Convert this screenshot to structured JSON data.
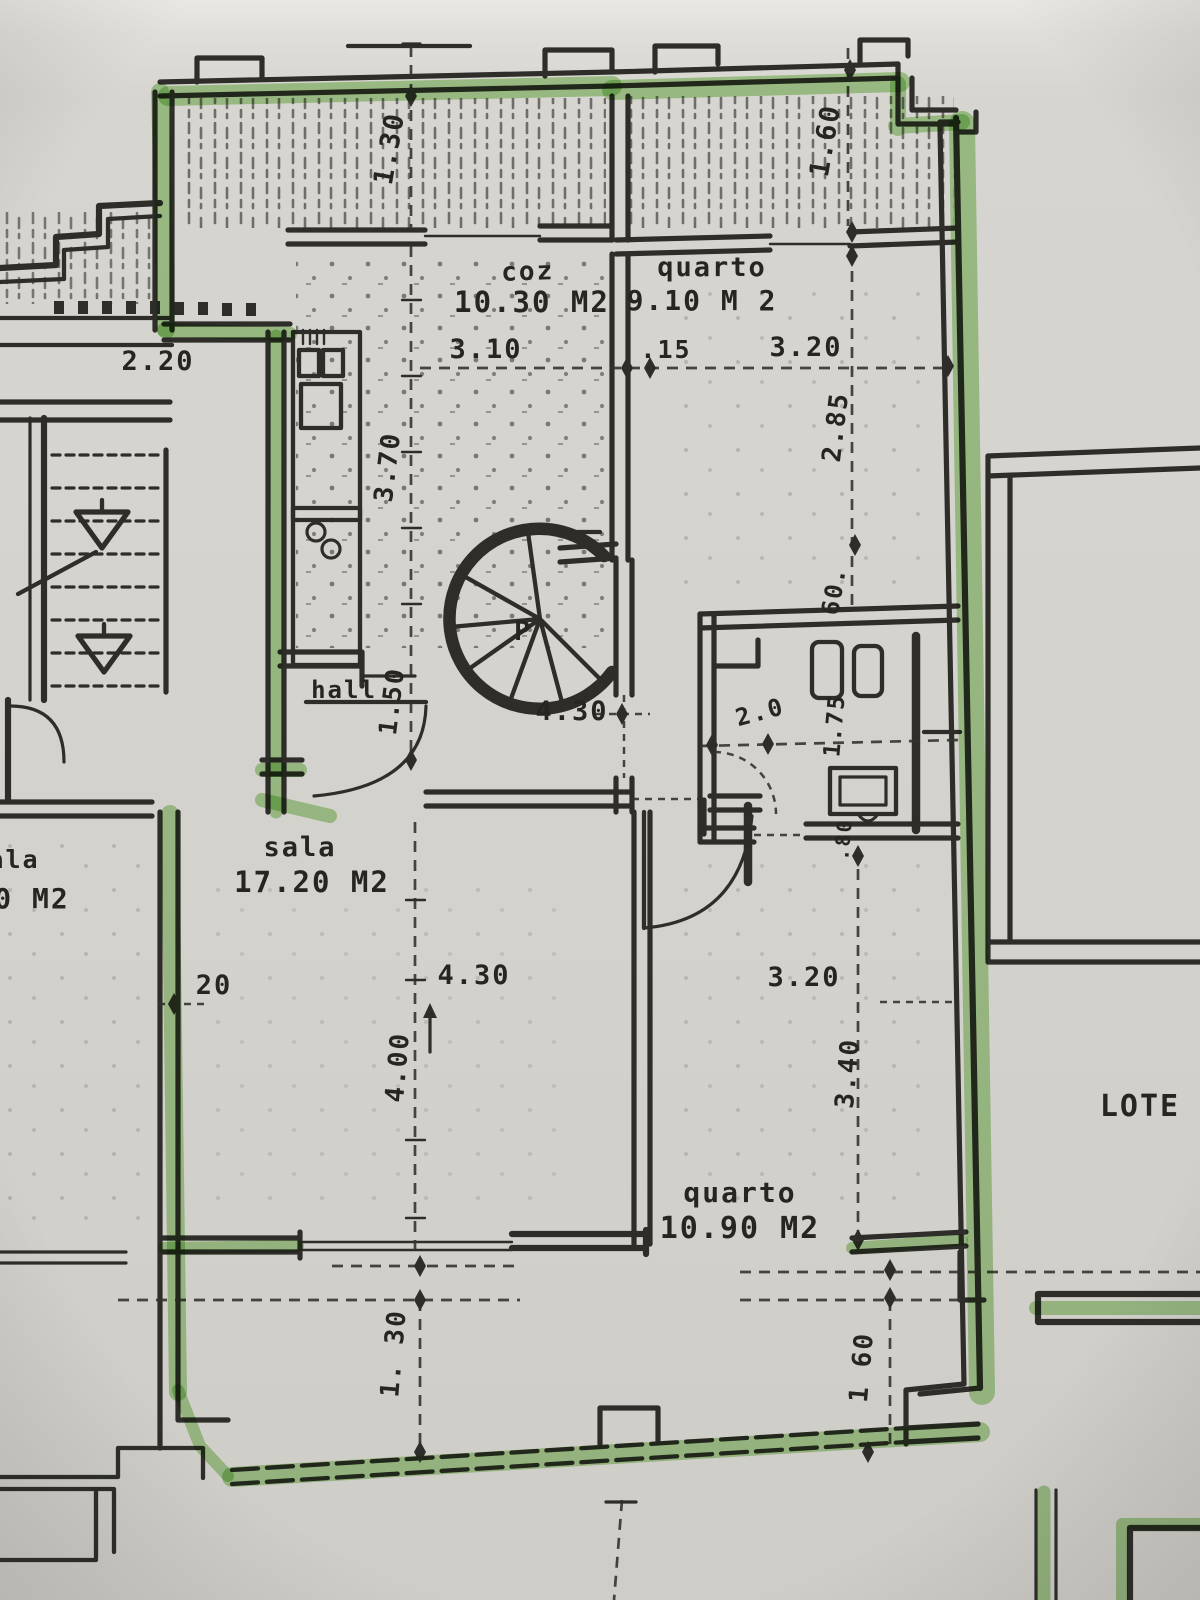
{
  "canvas": {
    "width": 1200,
    "height": 1600
  },
  "colors": {
    "paper": "#d6d4cf",
    "ink": "#2e2d29",
    "highlighter": "#86c763"
  },
  "rooms": {
    "cozinha": {
      "name": "coz",
      "area": "10.30 M2"
    },
    "quarto_top": {
      "name": "quarto",
      "area": "9.10 M 2"
    },
    "sala": {
      "name": "sala",
      "area": "17.20 M2"
    },
    "sala_neighbor": {
      "name": "ala",
      "area": "0 M2"
    },
    "quarto_bottom": {
      "name": "quarto",
      "area": "10.90 M2"
    },
    "hall": {
      "name": "hall"
    },
    "stair": {
      "label": "P"
    },
    "site": {
      "label": "LOTE"
    }
  },
  "dims": {
    "top_130": "1.30",
    "top_160": "1.60",
    "left_220": "2.20",
    "coz_width": "3.10",
    "wall_15": ".15",
    "quarto_top_width": "3.20",
    "coz_height": "3.70",
    "quarto_top_height": "2.85",
    "sixty": "60.",
    "hall_150": "1.50",
    "corridor_430": "4.30",
    "bath_20": "2.0",
    "bath_175": "1.75",
    "sala_20": "20",
    "sala_430": "4.30",
    "sala_400": "4.00",
    "quarto_bottom_width": "3.20",
    "quarto_bottom_height": "3.40",
    "door_80": ".80",
    "bottom_130": "1. 30",
    "bottom_160": "1 60"
  }
}
